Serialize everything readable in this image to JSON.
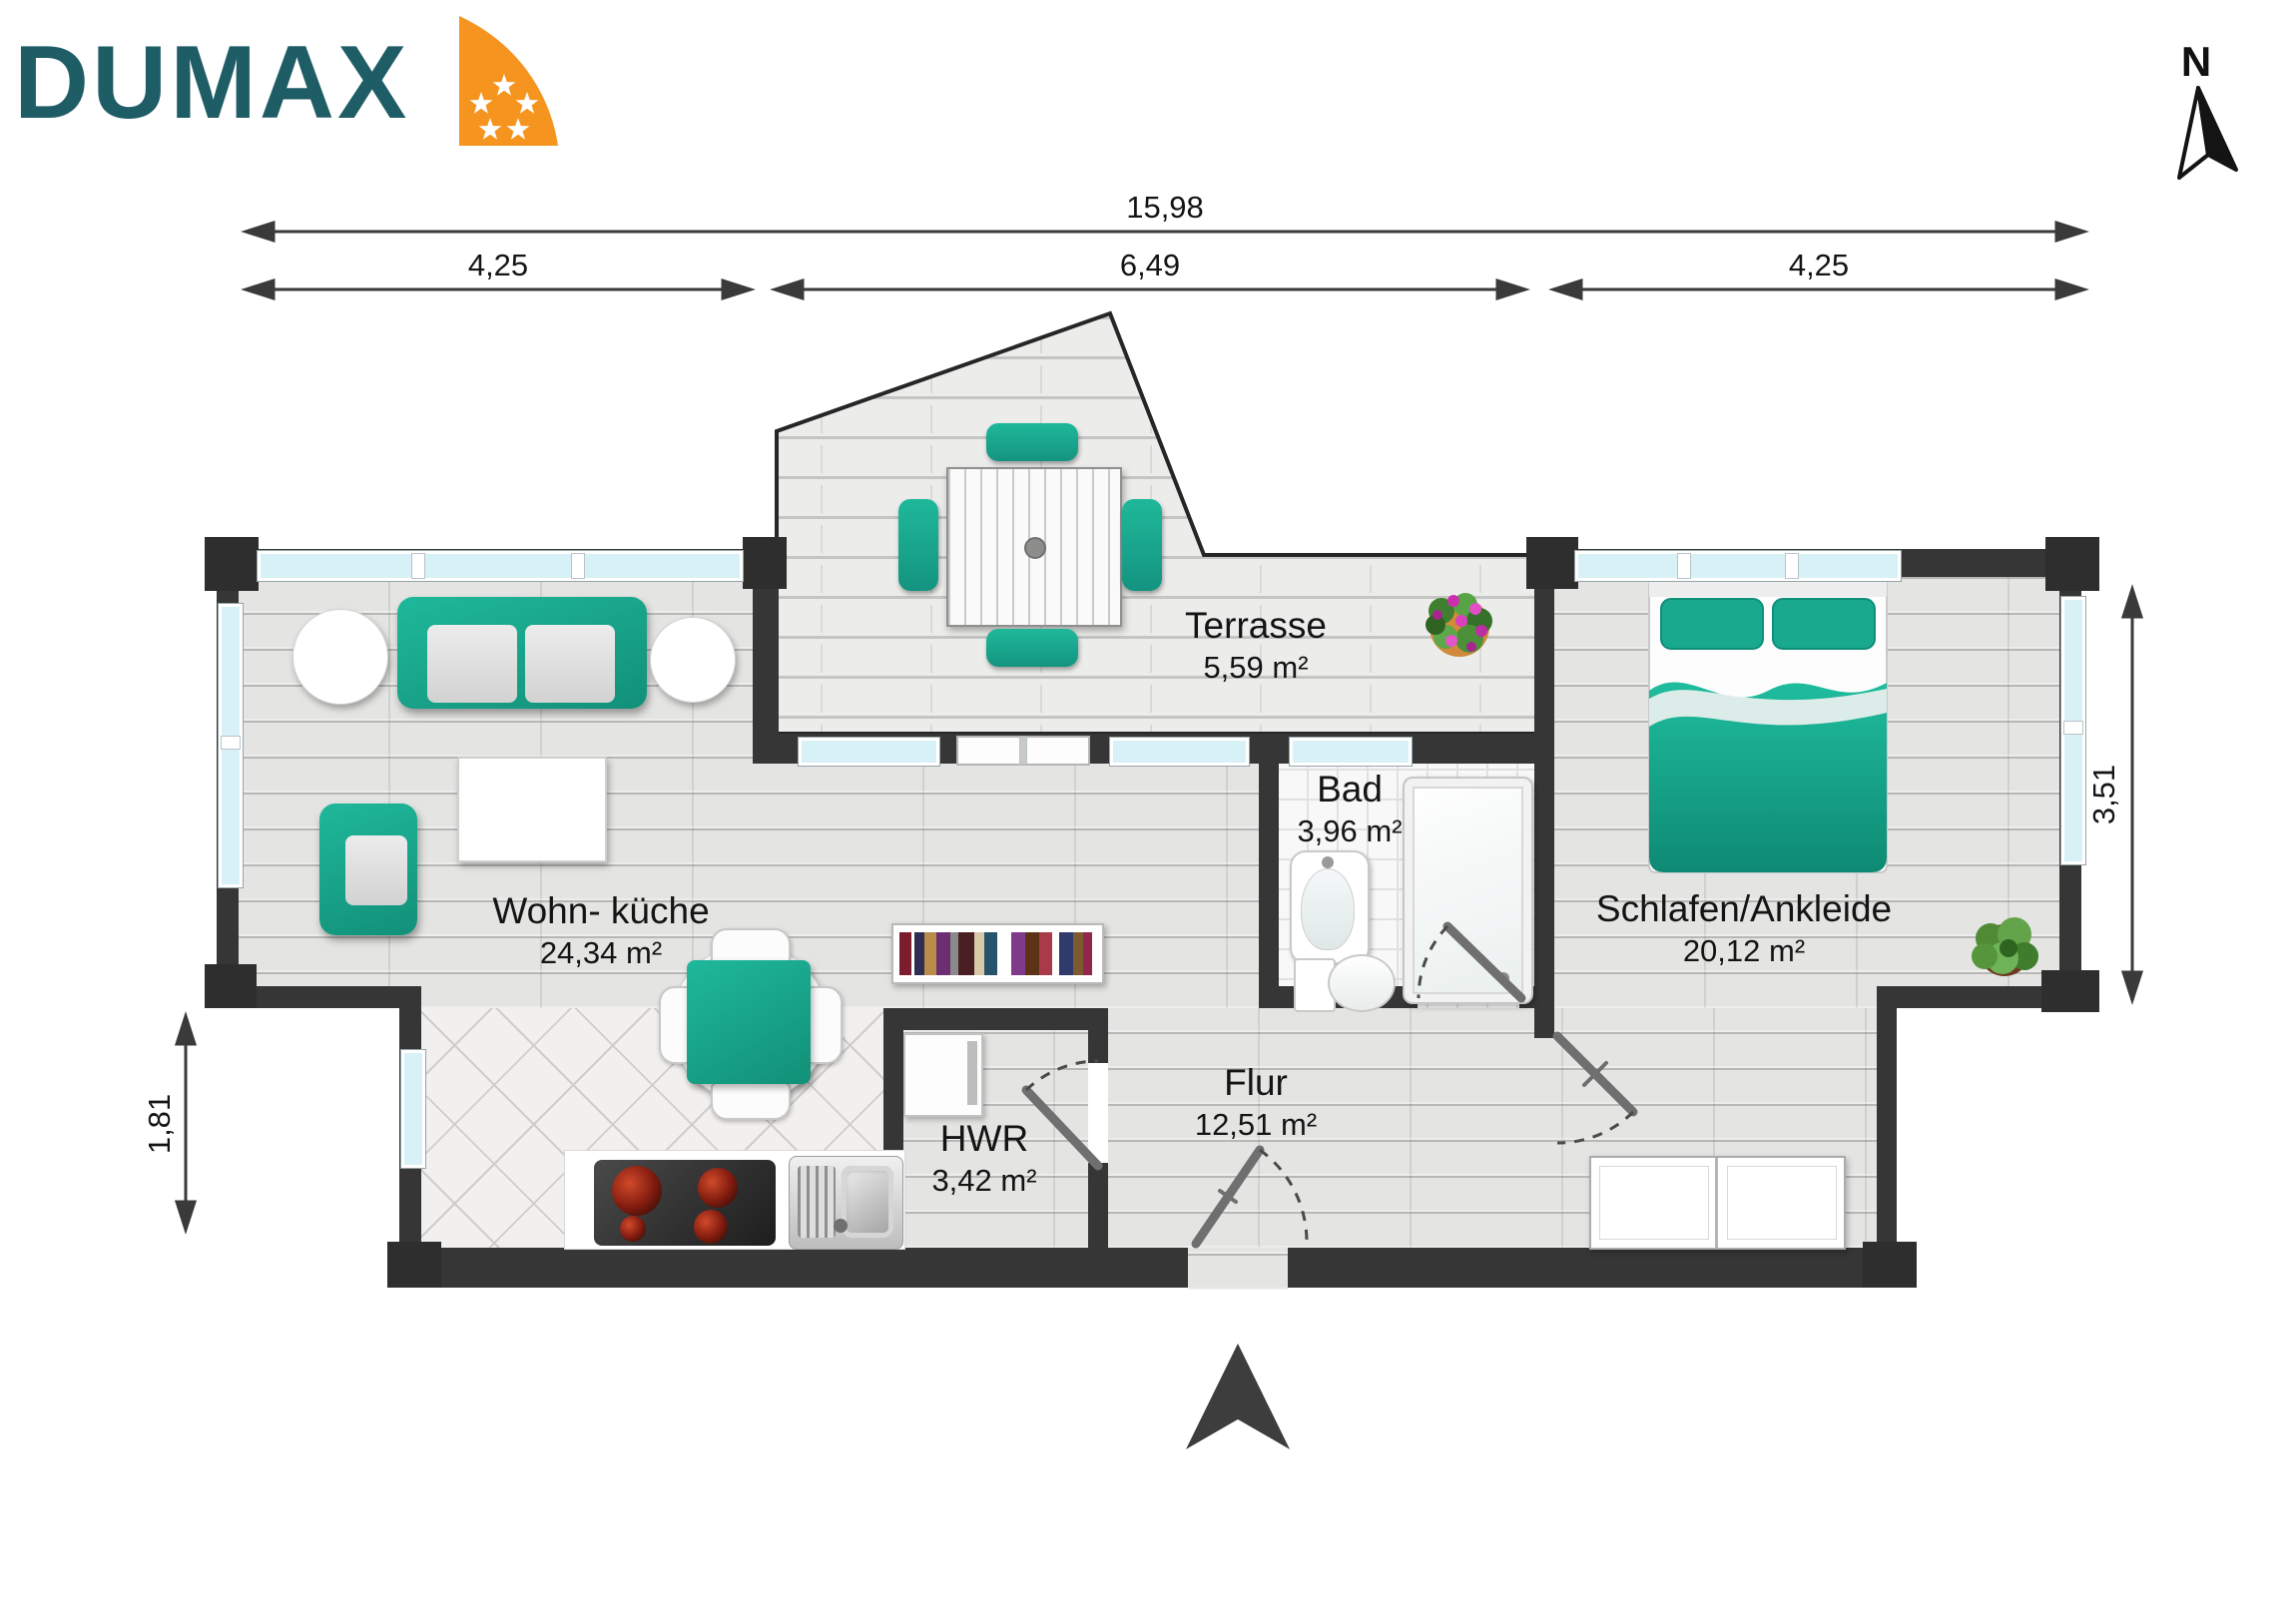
{
  "brand": {
    "name": "DUMAX"
  },
  "compass": {
    "label": "N"
  },
  "dimensions": {
    "total": "15,98",
    "seg_left": "4,25",
    "seg_mid": "6,49",
    "seg_right": "4,25",
    "left_height": "1,81",
    "right_height": "3,51"
  },
  "rooms": {
    "wohnkueche": {
      "name": "Wohn- küche",
      "area": "24,34 m²"
    },
    "terrasse": {
      "name": "Terrasse",
      "area": "5,59 m²"
    },
    "bad": {
      "name": "Bad",
      "area": "3,96 m²"
    },
    "schlafen": {
      "name": "Schlafen/Ankleide",
      "area": "20,12 m²"
    },
    "flur": {
      "name": "Flur",
      "area": "12,51 m²"
    },
    "hwr": {
      "name": "HWR",
      "area": "3,42 m²"
    }
  },
  "colors": {
    "wall": "#363636",
    "accent_teal": "#18A98F",
    "logo_teal": "#1F5D66",
    "logo_orange": "#F5941F",
    "window_glass": "#D8F1F7"
  }
}
